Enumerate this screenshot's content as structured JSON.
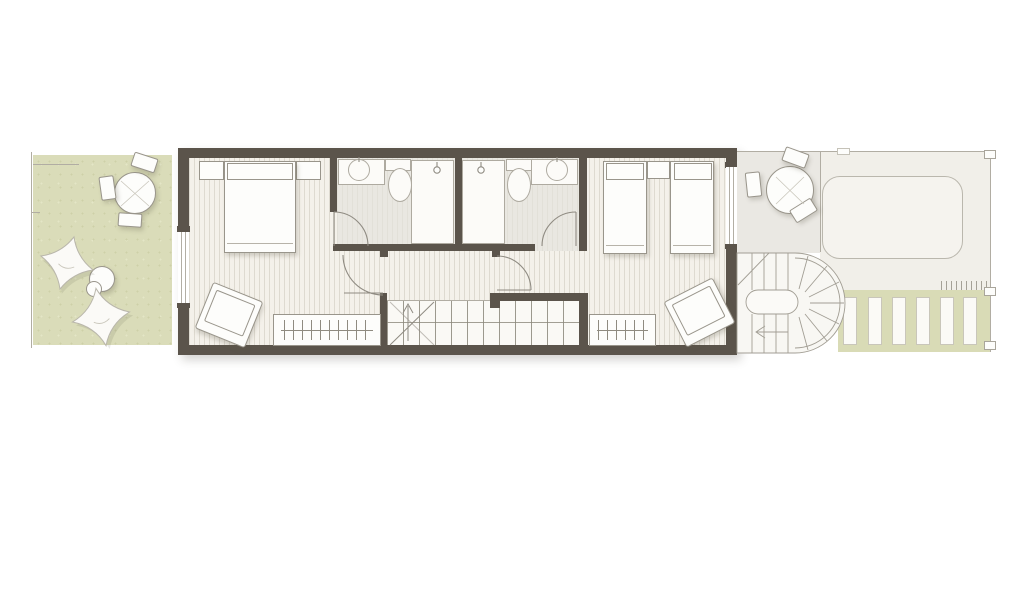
{
  "document": {
    "type": "architectural-floor-plan",
    "description": "Upper floor plan of a narrow row house with front garden terrace, two bedrooms, two bathrooms, central staircase, rear terrace with spiral stair, canopy and pergola",
    "visible_text": []
  },
  "palette": {
    "wall": "#5b544b",
    "floor_base": "#f4f1ea",
    "bath_floor": "#e9e7e1",
    "garden_green": "#dadcb9",
    "pergola_green": "#d9dbb6",
    "terrace_grey": "#eae8e3",
    "court_grey": "#f1efe9",
    "canopy_fill": "#f5f3ee",
    "fixture_fill": "#fcfbf8",
    "fixture_line": "#aeaaa0",
    "furniture_fill": "#fdfdfb",
    "furniture_line": "#99958b",
    "thin_line": "#b1ada3",
    "arc_line": "#8f8b82"
  },
  "rooms": [
    {
      "name": "garden-terrace",
      "side": "front-left",
      "furniture": [
        "round-dining-table",
        "chair",
        "chair",
        "chair",
        "bean-bag",
        "bean-bag",
        "side-table"
      ]
    },
    {
      "name": "bedroom-1",
      "furniture": [
        "double-bed",
        "nightstand",
        "nightstand",
        "armchair",
        "wardrobe-with-hangers"
      ],
      "openings": [
        "window-left",
        "door-to-hall"
      ]
    },
    {
      "name": "bathroom-1",
      "fixtures": [
        "vanity-basin",
        "toilet",
        "walk-in-shower"
      ]
    },
    {
      "name": "bathroom-2",
      "fixtures": [
        "walk-in-shower",
        "toilet",
        "vanity-basin"
      ]
    },
    {
      "name": "hallway",
      "features": [
        "main-staircase-with-up-arrow",
        "door-to-bedroom-1",
        "door-to-bedroom-2"
      ]
    },
    {
      "name": "bedroom-2",
      "furniture": [
        "twin-bed",
        "twin-bed",
        "nightstand",
        "armchair",
        "wardrobe-with-hangers"
      ],
      "openings": [
        "window-right",
        "door-to-hall"
      ]
    },
    {
      "name": "rear-terrace",
      "side": "rear",
      "furniture": [
        "round-dining-table",
        "chair",
        "chair",
        "chair"
      ],
      "features": [
        "spiral-staircase"
      ]
    },
    {
      "name": "rear-court",
      "features": [
        "canopy-outline",
        "pergola-with-slats",
        "hatch-strip",
        "corner-brackets"
      ]
    }
  ],
  "counts": {
    "main_stair_treads": 13,
    "spiral_stair_straight_treads": 8,
    "spiral_stair_fan_treads": 7,
    "pergola_slats": 6,
    "bean_bags": 2,
    "garden_chairs": 3,
    "terrace_chairs": 3
  }
}
